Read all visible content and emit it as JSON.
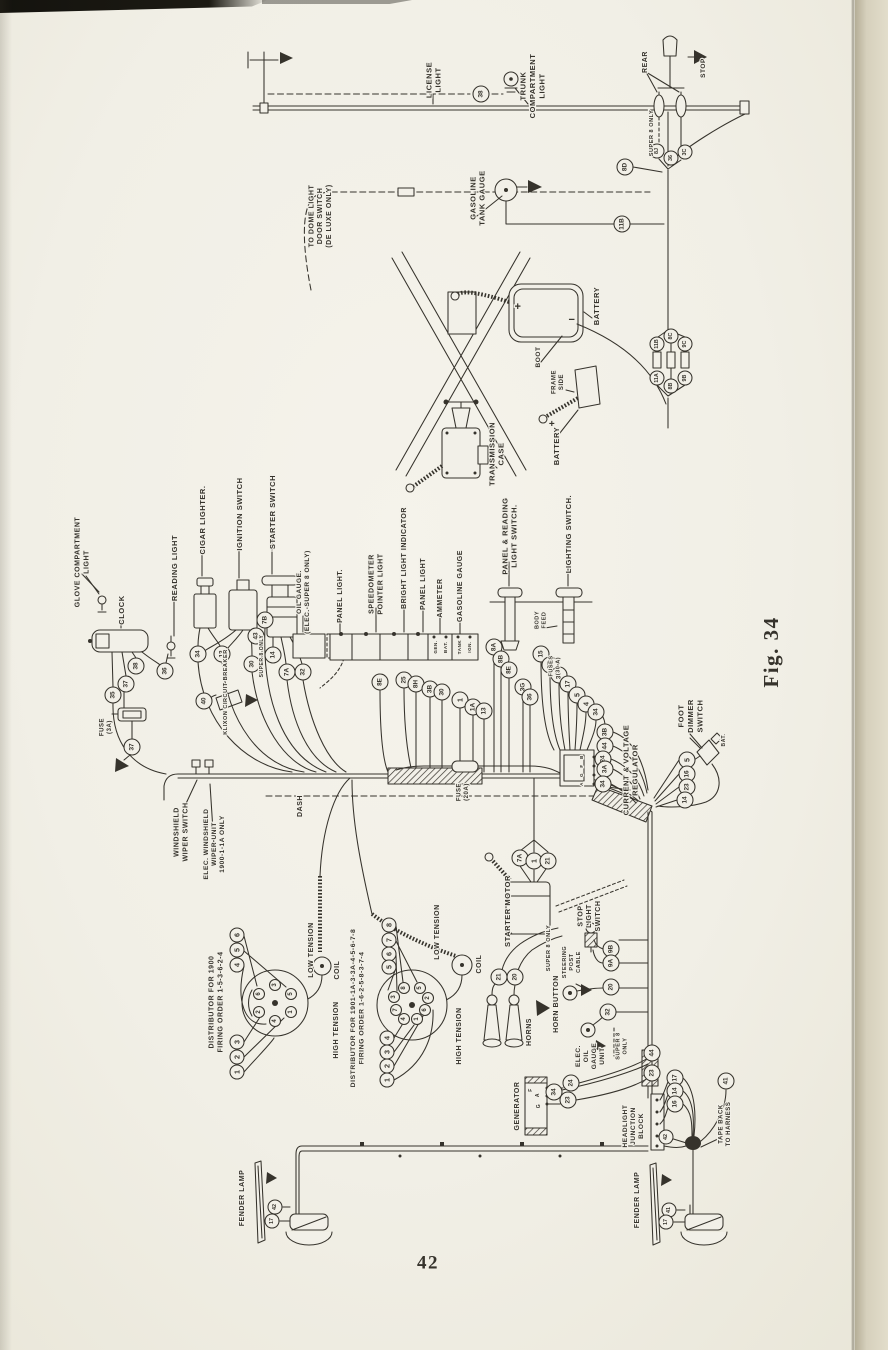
{
  "page": {
    "number": "42",
    "figure_caption": "Fig. 34",
    "colors": {
      "paper": "#f2f0e8",
      "ink": "#36332c",
      "page_edge": "#dcd6c3"
    }
  },
  "diagram": {
    "description": "Automobile chassis wiring diagram, rotated 90 degrees on book page",
    "labels": [
      {
        "id": "license-light",
        "t": "LICENSE\nLIGHT",
        "x": 433,
        "y": 80,
        "s": 7.5
      },
      {
        "id": "trunk-compartment-light",
        "t": "TRUNK\nCOMPARTMENT\nLIGHT",
        "x": 532,
        "y": 86,
        "s": 7.5
      },
      {
        "id": "rear",
        "t": "REAR",
        "x": 645,
        "y": 62,
        "s": 7
      },
      {
        "id": "stop",
        "t": "STOP",
        "x": 703,
        "y": 68,
        "s": 6.5
      },
      {
        "id": "super8-rear",
        "t": "SUPER 8 ONLY",
        "x": 652,
        "y": 133,
        "s": 5.5
      },
      {
        "id": "dome-switch",
        "t": "TO DOME LIGHT\nDOOR SWITCH\n(DE LUXE ONLY)",
        "x": 320,
        "y": 216,
        "s": 7
      },
      {
        "id": "gasoline-tank-gauge",
        "t": "GASOLINE\nTANK GAUGE",
        "x": 477,
        "y": 198,
        "s": 7.5
      },
      {
        "id": "battery-upper",
        "t": "BATTERY",
        "x": 596,
        "y": 306,
        "s": 7.5
      },
      {
        "id": "boot",
        "t": "BOOT",
        "x": 538,
        "y": 357,
        "s": 6.5
      },
      {
        "id": "frame-side",
        "t": "FRAME\nSIDE",
        "x": 558,
        "y": 382,
        "s": 6
      },
      {
        "id": "battery-lower",
        "t": "BATTERY",
        "x": 556,
        "y": 446,
        "s": 7.5
      },
      {
        "id": "transmission-case",
        "t": "TRANSMISSION\nCASE",
        "x": 496,
        "y": 454,
        "s": 7.5
      },
      {
        "id": "glove-compartment-light",
        "t": "GLOVE COMPARTMENT\nLIGHT",
        "x": 82,
        "y": 562,
        "s": 7
      },
      {
        "id": "clock",
        "t": "CLOCK",
        "x": 121,
        "y": 610,
        "s": 7.5
      },
      {
        "id": "reading-light",
        "t": "READING LIGHT",
        "x": 174,
        "y": 568,
        "s": 7.5
      },
      {
        "id": "cigar-lighter",
        "t": "CIGAR LIGHTER.",
        "x": 202,
        "y": 520,
        "s": 7.5
      },
      {
        "id": "ignition-switch",
        "t": "IGNITION SWITCH",
        "x": 239,
        "y": 514,
        "s": 7.5
      },
      {
        "id": "starter-switch",
        "t": "STARTER SWITCH",
        "x": 272,
        "y": 512,
        "s": 7.5
      },
      {
        "id": "oil-gauge",
        "t": "OIL GAUGE.\n(ELEC.-SUPER 8 ONLY)",
        "x": 303,
        "y": 592,
        "s": 6.5
      },
      {
        "id": "panel-light-1",
        "t": "PANEL LIGHT.",
        "x": 340,
        "y": 596,
        "s": 7
      },
      {
        "id": "speedometer-pointer-light",
        "t": "SPEEDOMETER\nPOINTER LIGHT",
        "x": 376,
        "y": 584,
        "s": 7
      },
      {
        "id": "bright-light-indicator",
        "t": "BRIGHT LIGHT INDICATOR",
        "x": 404,
        "y": 558,
        "s": 7
      },
      {
        "id": "panel-light-2",
        "t": "PANEL LIGHT",
        "x": 423,
        "y": 584,
        "s": 7
      },
      {
        "id": "ammeter",
        "t": "AMMETER",
        "x": 440,
        "y": 598,
        "s": 7
      },
      {
        "id": "gasoline-gauge",
        "t": "GASOLINE GAUGE",
        "x": 460,
        "y": 586,
        "s": 7
      },
      {
        "id": "panel-reading-light-switch",
        "t": "PANEL & READING\nLIGHT SWITCH.",
        "x": 509,
        "y": 536,
        "s": 7.5
      },
      {
        "id": "lighting-switch",
        "t": "LIGHTING SWITCH.",
        "x": 568,
        "y": 534,
        "s": 7.5
      },
      {
        "id": "body-feed",
        "t": "BODY\nFEED",
        "x": 541,
        "y": 620,
        "s": 5.5
      },
      {
        "id": "fuses-30a",
        "t": "FUSES\n(30 A)",
        "x": 555,
        "y": 666,
        "s": 5.5
      },
      {
        "id": "fuse-3a",
        "t": "FUSE\n(3A)",
        "x": 106,
        "y": 727,
        "s": 6
      },
      {
        "id": "klixon-circuit-breaker",
        "t": "KLIXON CIRCUIT BREAKER",
        "x": 226,
        "y": 692,
        "s": 5.5
      },
      {
        "id": "super8-ignition",
        "t": "SUPER 8 ONLY",
        "x": 262,
        "y": 656,
        "s": 5
      },
      {
        "id": "windshield-wiper-switch",
        "t": "WINDSHIELD\nWIPER SWITCH",
        "x": 181,
        "y": 832,
        "s": 7
      },
      {
        "id": "elec-wiper-unit",
        "t": "ELEC. WINDSHIELD\nWIPER UNIT\n1900-1-1A ONLY",
        "x": 214,
        "y": 844,
        "s": 6.5
      },
      {
        "id": "dash",
        "t": "DASH",
        "x": 300,
        "y": 806,
        "s": 7
      },
      {
        "id": "fuse-20a",
        "t": "FUSE\n(20A)",
        "x": 463,
        "y": 792,
        "s": 6
      },
      {
        "id": "current-voltage-regulator",
        "t": "CURRENT & VOLTAGE\nREGULATOR",
        "x": 630,
        "y": 770,
        "s": 7.5
      },
      {
        "id": "foot-dimmer-switch",
        "t": "FOOT\nDIMMER\nSWITCH",
        "x": 690,
        "y": 716,
        "s": 7.5
      },
      {
        "id": "bat-dimmer",
        "t": "BAT.",
        "x": 724,
        "y": 740,
        "s": 5
      },
      {
        "id": "starter-motor",
        "t": "STARTER MOTOR",
        "x": 507,
        "y": 911,
        "s": 7.5
      },
      {
        "id": "super8-starter",
        "t": "SUPER 8 ONLY",
        "x": 549,
        "y": 948,
        "s": 5.5
      },
      {
        "id": "stop-light-switch",
        "t": "STOP\nLIGHT\nSWITCH",
        "x": 589,
        "y": 916,
        "s": 7
      },
      {
        "id": "steering-post-cable",
        "t": "STEERING\nPOST\nCABLE",
        "x": 572,
        "y": 962,
        "s": 5.5
      },
      {
        "id": "horn-button",
        "t": "HORN BUTTON",
        "x": 556,
        "y": 1004,
        "s": 7
      },
      {
        "id": "elec-oil-gauge-unit",
        "t": "ELEC.\nOIL\nGAUGE\nUNIT",
        "x": 590,
        "y": 1056,
        "s": 6.5
      },
      {
        "id": "super8-oil",
        "t": "SUPER 8\nONLY",
        "x": 622,
        "y": 1046,
        "s": 5.5
      },
      {
        "id": "horns",
        "t": "HORNS",
        "x": 529,
        "y": 1032,
        "s": 7
      },
      {
        "id": "distributor-1900",
        "t": "DISTRIBUTOR FOR 1900\nFIRING ORDER   1-5-3-6-2-4",
        "x": 216,
        "y": 1002,
        "s": 7
      },
      {
        "id": "low-tension-1",
        "t": "LOW TENSION",
        "x": 311,
        "y": 950,
        "s": 7
      },
      {
        "id": "coil-1",
        "t": "COIL",
        "x": 337,
        "y": 970,
        "s": 7
      },
      {
        "id": "high-tension-1",
        "t": "HIGH TENSION",
        "x": 336,
        "y": 1030,
        "s": 7
      },
      {
        "id": "distributor-1901",
        "t": "DISTRIBUTOR FOR 1901-1A-3-3A-4-5-6-7-8\nFIRING ORDER   1-6-2-5-8-3-7-4",
        "x": 357,
        "y": 1008,
        "s": 6.8
      },
      {
        "id": "low-tension-2",
        "t": "LOW TENSION",
        "x": 437,
        "y": 932,
        "s": 7
      },
      {
        "id": "coil-2",
        "t": "COIL",
        "x": 479,
        "y": 964,
        "s": 7
      },
      {
        "id": "high-tension-2",
        "t": "HIGH TENSION",
        "x": 459,
        "y": 1036,
        "s": 7
      },
      {
        "id": "generator",
        "t": "GENERATOR",
        "x": 517,
        "y": 1106,
        "s": 7
      },
      {
        "id": "headlight-junction-block",
        "t": "HEADLIGHT\nJUNCTION\nBLOCK",
        "x": 633,
        "y": 1126,
        "s": 6.5
      },
      {
        "id": "tape-back-to-harness",
        "t": "TAPE BACK\nTO HARNESS",
        "x": 725,
        "y": 1124,
        "s": 6
      },
      {
        "id": "fender-lamp-left",
        "t": "FENDER LAMP",
        "x": 242,
        "y": 1198,
        "s": 7
      },
      {
        "id": "fender-lamp-right",
        "t": "FENDER LAMP",
        "x": 637,
        "y": 1200,
        "s": 7
      },
      {
        "id": "ammeter-gen-terminal",
        "t": "GEN.",
        "x": 435,
        "y": 647,
        "s": 4.5
      },
      {
        "id": "ammeter-bat-terminal",
        "t": "BAT.",
        "x": 445,
        "y": 647,
        "s": 4.5
      },
      {
        "id": "gas-tank-terminal",
        "t": "TANK",
        "x": 459,
        "y": 647,
        "s": 4.5
      },
      {
        "id": "gas-ign-terminal",
        "t": "IGN.",
        "x": 469,
        "y": 647,
        "s": 4.5
      },
      {
        "id": "battery-plus-upper",
        "t": "+",
        "x": 518,
        "y": 307,
        "s": 11,
        "r": 0
      },
      {
        "id": "battery-minus-upper",
        "t": "−",
        "x": 572,
        "y": 320,
        "s": 11,
        "r": 0
      },
      {
        "id": "battery-plus-lower",
        "t": "+",
        "x": 552,
        "y": 424,
        "s": 10,
        "r": 0
      },
      {
        "id": "generator-f-terminal",
        "t": "F",
        "x": 531,
        "y": 1090,
        "s": 5
      },
      {
        "id": "generator-a-terminal",
        "t": "A",
        "x": 538,
        "y": 1095,
        "s": 5
      },
      {
        "id": "generator-g-terminal",
        "t": "G",
        "x": 539,
        "y": 1106,
        "s": 5
      },
      {
        "id": "regulator-b-terminal",
        "t": "B",
        "x": 581,
        "y": 757,
        "s": 4.5
      },
      {
        "id": "regulator-f-terminal",
        "t": "F",
        "x": 581,
        "y": 766,
        "s": 4.5
      },
      {
        "id": "regulator-g-terminal",
        "t": "G",
        "x": 581,
        "y": 775,
        "s": 4.5
      },
      {
        "id": "regulator-a-terminal",
        "t": "A",
        "x": 581,
        "y": 784,
        "s": 4.5
      }
    ],
    "circles": [
      {
        "t": "38",
        "x": 481,
        "y": 94
      },
      {
        "t": "8J",
        "x": 657,
        "y": 151,
        "r": 7
      },
      {
        "t": "36",
        "x": 671,
        "y": 158,
        "r": 7
      },
      {
        "t": "3C",
        "x": 685,
        "y": 152,
        "r": 7
      },
      {
        "t": "8D",
        "x": 625,
        "y": 167
      },
      {
        "t": "11B",
        "x": 622,
        "y": 224
      },
      {
        "t": "11B",
        "x": 657,
        "y": 344,
        "r": 7
      },
      {
        "t": "8C",
        "x": 671,
        "y": 336,
        "r": 7
      },
      {
        "t": "9C",
        "x": 685,
        "y": 344,
        "r": 7
      },
      {
        "t": "11A",
        "x": 657,
        "y": 378,
        "r": 7
      },
      {
        "t": "8B",
        "x": 671,
        "y": 386,
        "r": 7
      },
      {
        "t": "9B",
        "x": 685,
        "y": 378,
        "r": 7
      },
      {
        "t": "38",
        "x": 136,
        "y": 666
      },
      {
        "t": "37",
        "x": 126,
        "y": 684
      },
      {
        "t": "35",
        "x": 113,
        "y": 695
      },
      {
        "t": "36",
        "x": 165,
        "y": 671
      },
      {
        "t": "34",
        "x": 198,
        "y": 654
      },
      {
        "t": "13",
        "x": 222,
        "y": 654
      },
      {
        "t": "30",
        "x": 252,
        "y": 664
      },
      {
        "t": "40",
        "x": 204,
        "y": 701
      },
      {
        "t": "37",
        "x": 132,
        "y": 747
      },
      {
        "t": "7B",
        "x": 265,
        "y": 620
      },
      {
        "t": "43",
        "x": 256,
        "y": 636
      },
      {
        "t": "14",
        "x": 273,
        "y": 655
      },
      {
        "t": "7A",
        "x": 287,
        "y": 672
      },
      {
        "t": "32",
        "x": 303,
        "y": 672
      },
      {
        "t": "8E",
        "x": 380,
        "y": 682
      },
      {
        "t": "25",
        "x": 404,
        "y": 680
      },
      {
        "t": "8H",
        "x": 416,
        "y": 684
      },
      {
        "t": "3B",
        "x": 430,
        "y": 689
      },
      {
        "t": "30",
        "x": 442,
        "y": 692
      },
      {
        "t": "1",
        "x": 460,
        "y": 700
      },
      {
        "t": "1A",
        "x": 473,
        "y": 707
      },
      {
        "t": "13",
        "x": 484,
        "y": 711
      },
      {
        "t": "8A",
        "x": 494,
        "y": 647
      },
      {
        "t": "8B",
        "x": 501,
        "y": 659
      },
      {
        "t": "8E",
        "x": 509,
        "y": 670
      },
      {
        "t": "3G",
        "x": 523,
        "y": 687
      },
      {
        "t": "36",
        "x": 530,
        "y": 697
      },
      {
        "t": "15",
        "x": 541,
        "y": 654
      },
      {
        "t": "5F",
        "x": 550,
        "y": 665
      },
      {
        "t": "3A",
        "x": 559,
        "y": 675
      },
      {
        "t": "17",
        "x": 568,
        "y": 684
      },
      {
        "t": "5",
        "x": 577,
        "y": 695
      },
      {
        "t": "4",
        "x": 586,
        "y": 704
      },
      {
        "t": "34",
        "x": 596,
        "y": 712
      },
      {
        "t": "3B",
        "x": 605,
        "y": 732
      },
      {
        "t": "44",
        "x": 605,
        "y": 746
      },
      {
        "t": "24",
        "x": 603,
        "y": 759
      },
      {
        "t": "3A",
        "x": 605,
        "y": 769
      },
      {
        "t": "34",
        "x": 603,
        "y": 784
      },
      {
        "t": "5",
        "x": 687,
        "y": 760
      },
      {
        "t": "16",
        "x": 687,
        "y": 774
      },
      {
        "t": "23",
        "x": 687,
        "y": 787
      },
      {
        "t": "14",
        "x": 685,
        "y": 800
      },
      {
        "t": "7A",
        "x": 520,
        "y": 858
      },
      {
        "t": "1",
        "x": 534,
        "y": 861
      },
      {
        "t": "21",
        "x": 548,
        "y": 861
      },
      {
        "t": "9B",
        "x": 611,
        "y": 949
      },
      {
        "t": "9A",
        "x": 611,
        "y": 963
      },
      {
        "t": "20",
        "x": 611,
        "y": 987
      },
      {
        "t": "32",
        "x": 608,
        "y": 1012
      },
      {
        "t": "21",
        "x": 499,
        "y": 977
      },
      {
        "t": "20",
        "x": 515,
        "y": 977
      },
      {
        "t": "6",
        "x": 237,
        "y": 935,
        "r": 7
      },
      {
        "t": "5",
        "x": 237,
        "y": 950,
        "r": 7
      },
      {
        "t": "4",
        "x": 237,
        "y": 965,
        "r": 7
      },
      {
        "t": "3",
        "x": 237,
        "y": 1042,
        "r": 7
      },
      {
        "t": "2",
        "x": 237,
        "y": 1057,
        "r": 7
      },
      {
        "t": "1",
        "x": 237,
        "y": 1072,
        "r": 7
      },
      {
        "t": "3",
        "x": 275,
        "y": 985,
        "r": 5.5
      },
      {
        "t": "5",
        "x": 291,
        "y": 994,
        "r": 5.5
      },
      {
        "t": "1",
        "x": 291,
        "y": 1012,
        "r": 5.5
      },
      {
        "t": "4",
        "x": 275,
        "y": 1021,
        "r": 5.5
      },
      {
        "t": "2",
        "x": 259,
        "y": 1012,
        "r": 5.5
      },
      {
        "t": "6",
        "x": 259,
        "y": 994,
        "r": 5.5
      },
      {
        "t": "8",
        "x": 389,
        "y": 925,
        "r": 7
      },
      {
        "t": "7",
        "x": 389,
        "y": 940,
        "r": 7
      },
      {
        "t": "6",
        "x": 389,
        "y": 954,
        "r": 7
      },
      {
        "t": "5",
        "x": 389,
        "y": 967,
        "r": 7
      },
      {
        "t": "4",
        "x": 387,
        "y": 1038,
        "r": 7
      },
      {
        "t": "3",
        "x": 387,
        "y": 1052,
        "r": 7
      },
      {
        "t": "2",
        "x": 387,
        "y": 1066,
        "r": 7
      },
      {
        "t": "1",
        "x": 387,
        "y": 1080,
        "r": 7
      },
      {
        "t": "8",
        "x": 404,
        "y": 988,
        "r": 5.5
      },
      {
        "t": "5",
        "x": 420,
        "y": 988,
        "r": 5.5
      },
      {
        "t": "2",
        "x": 428,
        "y": 998,
        "r": 5.5
      },
      {
        "t": "6",
        "x": 425,
        "y": 1010,
        "r": 5.5
      },
      {
        "t": "1",
        "x": 417,
        "y": 1019,
        "r": 5.5
      },
      {
        "t": "4",
        "x": 404,
        "y": 1019,
        "r": 5.5
      },
      {
        "t": "7",
        "x": 396,
        "y": 1010,
        "r": 5.5
      },
      {
        "t": "3",
        "x": 394,
        "y": 997,
        "r": 5.5
      },
      {
        "t": "24",
        "x": 571,
        "y": 1083
      },
      {
        "t": "34",
        "x": 554,
        "y": 1092
      },
      {
        "t": "23",
        "x": 568,
        "y": 1100
      },
      {
        "t": "44",
        "x": 652,
        "y": 1053
      },
      {
        "t": "23",
        "x": 652,
        "y": 1073
      },
      {
        "t": "17",
        "x": 675,
        "y": 1078
      },
      {
        "t": "14",
        "x": 675,
        "y": 1091
      },
      {
        "t": "16",
        "x": 675,
        "y": 1104
      },
      {
        "t": "42",
        "x": 666,
        "y": 1137,
        "r": 7
      },
      {
        "t": "41",
        "x": 726,
        "y": 1081
      },
      {
        "t": "42",
        "x": 275,
        "y": 1207,
        "r": 7
      },
      {
        "t": "17",
        "x": 272,
        "y": 1221,
        "r": 7
      },
      {
        "t": "41",
        "x": 669,
        "y": 1210,
        "r": 7
      },
      {
        "t": "17",
        "x": 666,
        "y": 1222,
        "r": 7
      }
    ]
  }
}
